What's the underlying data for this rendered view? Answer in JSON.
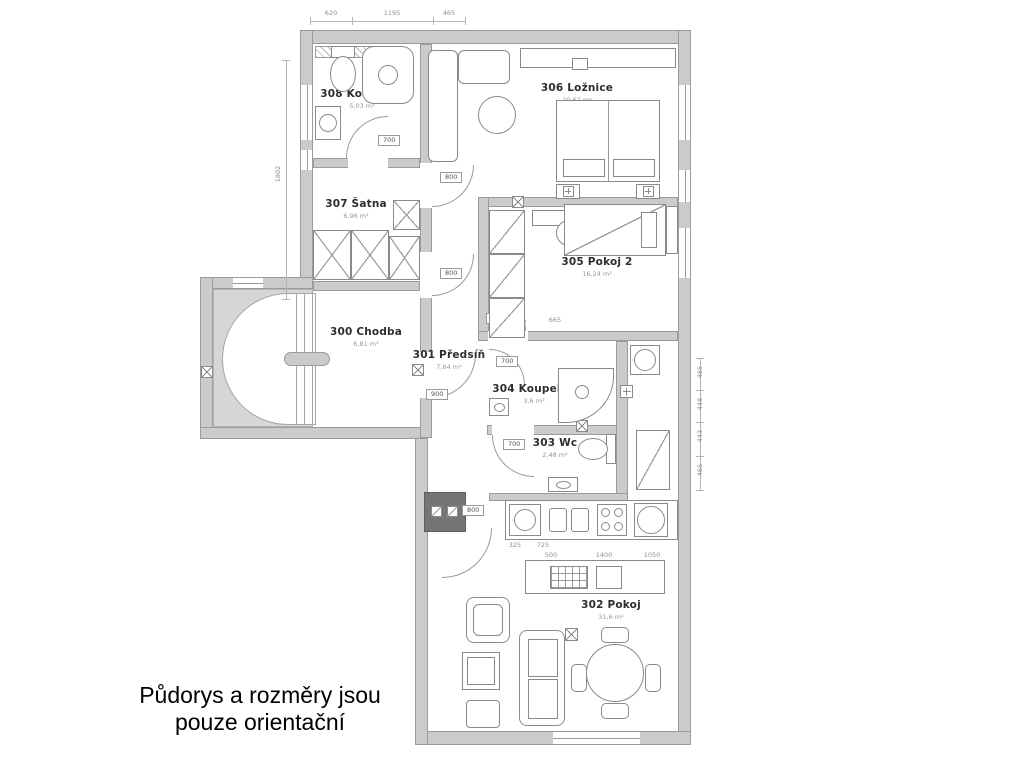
{
  "caption": {
    "line1": "Půdorys a rozměry jsou",
    "line2": "pouze orientační"
  },
  "rooms": {
    "r300": {
      "name": "300 Chodba",
      "area": "6,81 m²"
    },
    "r301": {
      "name": "301 Předsíň",
      "area": "7,64 m²"
    },
    "r302": {
      "name": "302 Pokoj",
      "area": "31,6 m²"
    },
    "r303": {
      "name": "303 Wc",
      "area": "2,48 m²"
    },
    "r304": {
      "name": "304 Koupelna",
      "area": "3,6 m²"
    },
    "r305": {
      "name": "305 Pokoj 2",
      "area": "16,24 m²"
    },
    "r306": {
      "name": "306 Ložnice",
      "area": "20,67 m²"
    },
    "r307": {
      "name": "307 Šatna",
      "area": "6,96 m²"
    },
    "r308": {
      "name": "308 Koupelna",
      "area": "5,03 m²"
    }
  },
  "door_widths": {
    "bath308": "700",
    "satna": "800",
    "hall": "800",
    "kitchen_pass": "800",
    "predsin": "900",
    "koupelna304": "700",
    "wc": "700",
    "pokoj302": "800"
  },
  "dimensions": {
    "top": [
      "620",
      "1195",
      "465"
    ],
    "left": [
      "1802"
    ],
    "right": [
      "465",
      "448",
      "443",
      "465"
    ],
    "inner": [
      "1640",
      "665"
    ],
    "kitchen": [
      "325",
      "725",
      "500",
      "1400",
      "1050"
    ]
  },
  "colors": {
    "wall_fill": "#cbcbcb",
    "wall_stroke": "#9b9b9b",
    "furniture_stroke": "#8a8a8a",
    "stove_block": "#757575",
    "label_text": "#2d2d2d",
    "area_text": "#979797"
  }
}
